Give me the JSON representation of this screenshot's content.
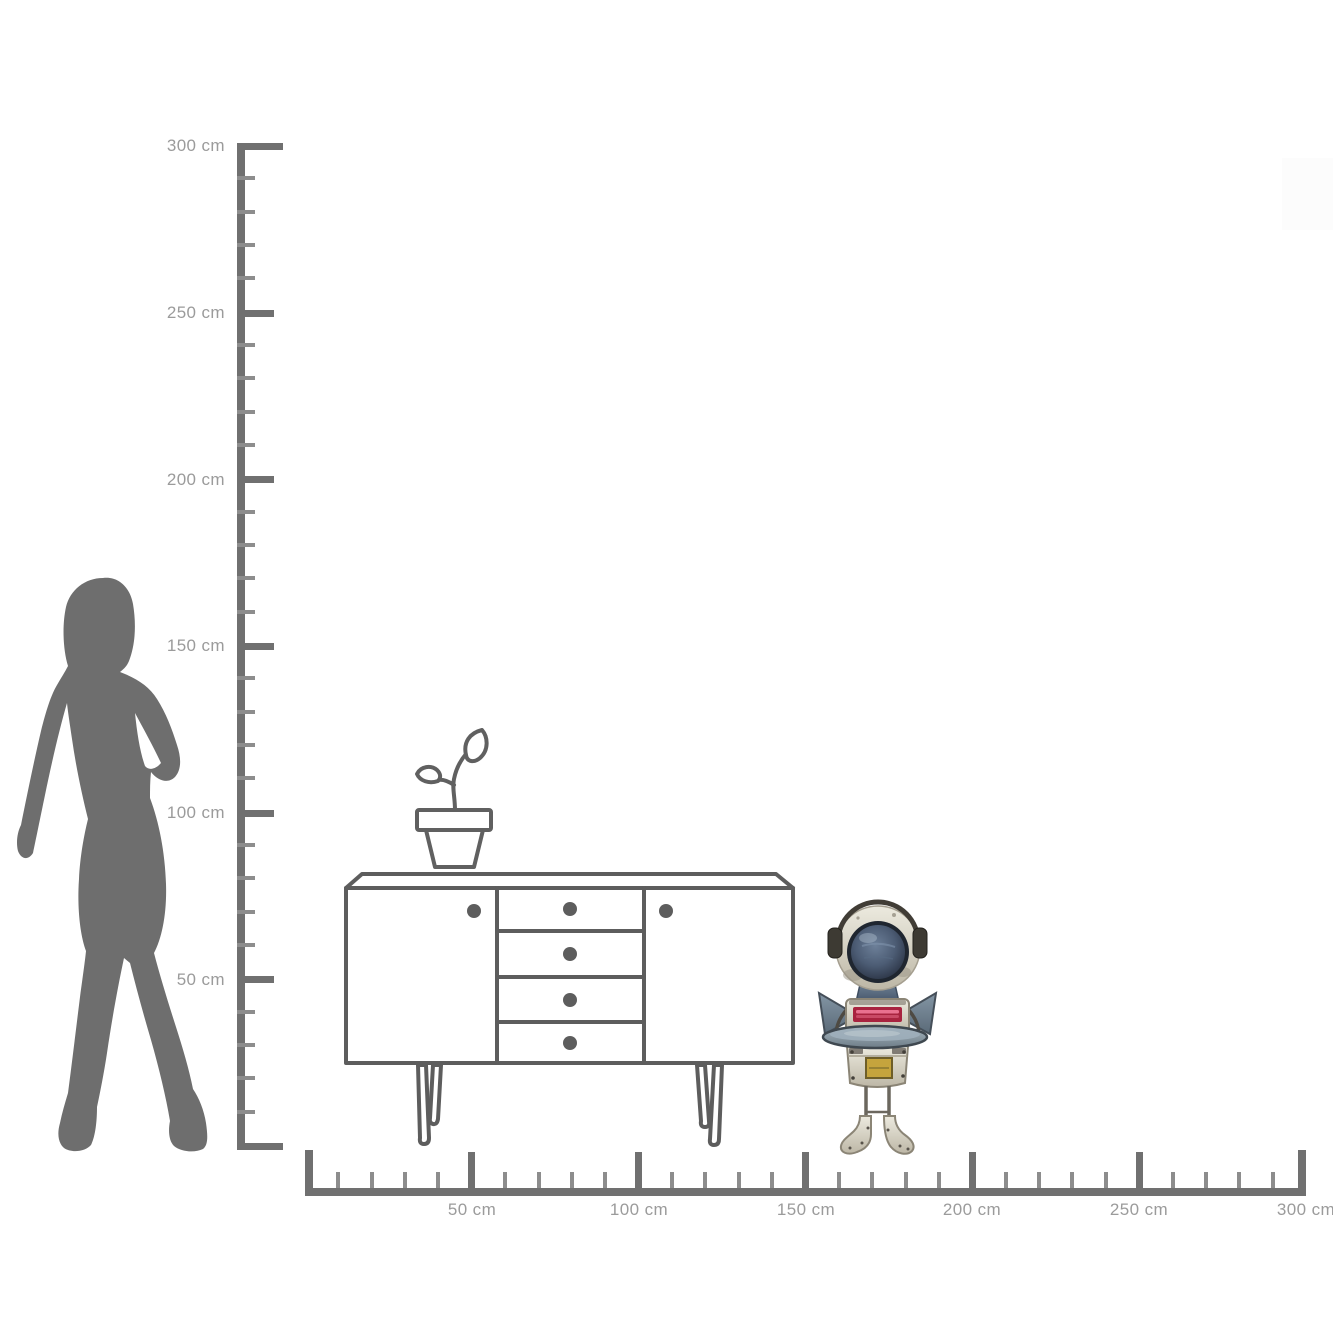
{
  "diagram": {
    "kind": "product-size-scale-diagram",
    "unit": "cm",
    "background": "#ffffff",
    "vertical_ruler": {
      "min_cm": 0,
      "max_cm": 300,
      "major_step_cm": 50,
      "minor_step_cm": 10,
      "labels": [
        "300 cm",
        "250 cm",
        "200 cm",
        "150 cm",
        "100 cm",
        "50 cm"
      ]
    },
    "horizontal_ruler": {
      "min_cm": 0,
      "max_cm": 300,
      "major_step_cm": 50,
      "minor_step_cm": 10,
      "labels": [
        "50 cm",
        "100 cm",
        "150 cm",
        "200 cm",
        "250 cm",
        "300 cm"
      ]
    },
    "colors": {
      "ruler": "#707070",
      "minor_tick": "#8d8d8d",
      "label_text": "#9b9b9b",
      "silhouette": "#6e6e6e",
      "furniture_outline": "#5d5d5d",
      "robot_cream": "#d8d3c5",
      "robot_dome_blue": "#4c5c74",
      "robot_saucer_blue": "#8fa0ad",
      "robot_slot_red": "#a8233f",
      "robot_plate_yellow": "#c5a43d"
    },
    "figures": {
      "person": {
        "name": "woman-silhouette",
        "approx_height_cm": 170
      },
      "sideboard": {
        "name": "sideboard-outline",
        "doors": 2,
        "drawers": 4,
        "approx_width_cm": 134,
        "approx_height_cm": 81
      },
      "plant": {
        "name": "potted-plant-outline"
      },
      "product": {
        "name": "robot-figurine",
        "approx_height_cm": 74
      }
    }
  }
}
